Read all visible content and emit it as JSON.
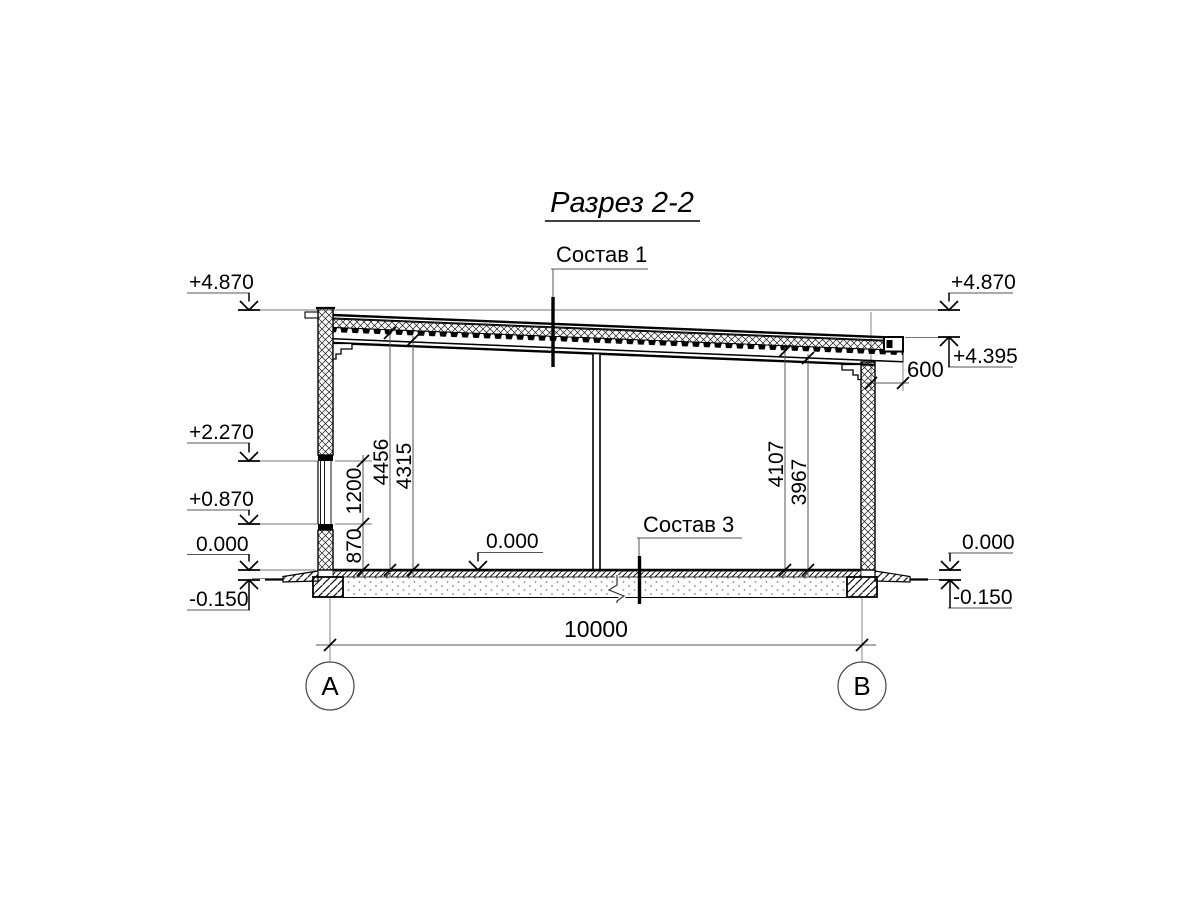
{
  "title": "Разрез 2-2",
  "callouts": {
    "layer1": "Состав 1",
    "layer3": "Состав 3"
  },
  "elevations": {
    "left": [
      "+4.870",
      "+2.270",
      "+0.870",
      "0.000",
      "-0.150"
    ],
    "right": [
      "+4.870",
      "+4.395",
      "0.000",
      "-0.150"
    ],
    "floor_interior": "0.000"
  },
  "dimensions": {
    "overall_width": "10000",
    "roof_overhang": "600",
    "window_sill_height": "870",
    "window_height": "1200",
    "ceiling_height_left_1": "4456",
    "ceiling_height_left_2": "4315",
    "ceiling_height_right_1": "4107",
    "ceiling_height_right_2": "3967"
  },
  "axes": {
    "left": "A",
    "right": "B"
  }
}
